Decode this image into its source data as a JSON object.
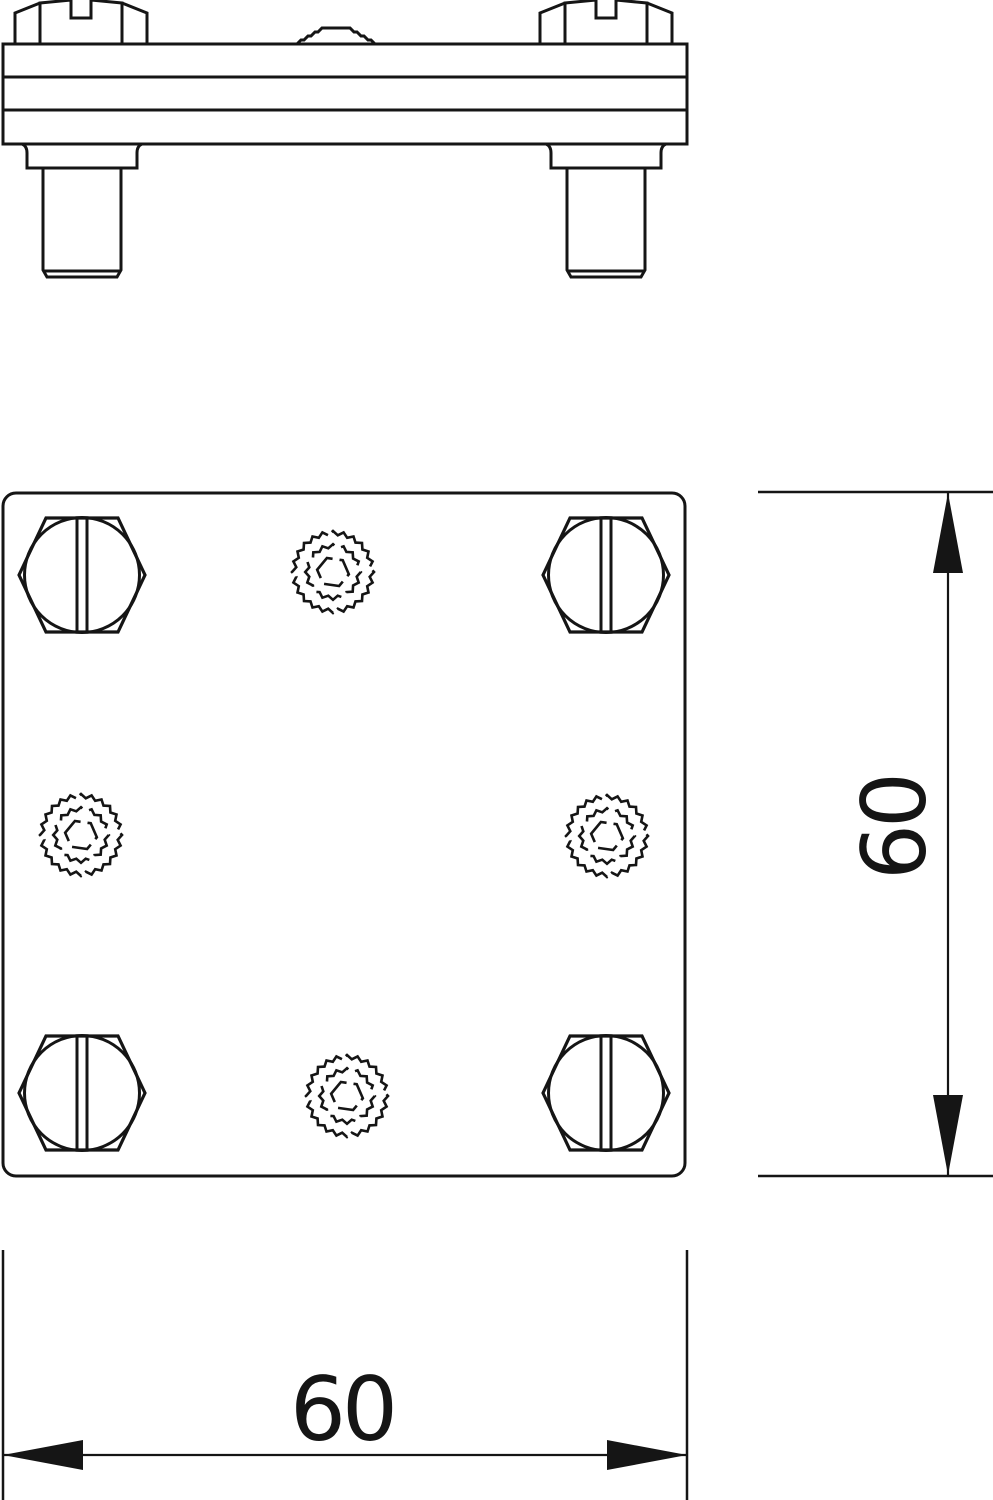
{
  "drawing": {
    "title": "cross-connector-technical-drawing",
    "line_color": "#151515",
    "background": "#ffffff"
  },
  "side_view": {
    "plate": {
      "x1": 3,
      "x2": 687,
      "y_top": 44,
      "y_mid1": 77,
      "y_mid2": 110,
      "y_bottom": 144
    },
    "bolt_heads": [
      {
        "cx": 81
      },
      {
        "cx": 606
      }
    ],
    "studs": [
      {
        "cx": 82
      },
      {
        "cx": 606
      }
    ],
    "dome": {
      "cx": 336,
      "base_y": 44,
      "top_y": 28,
      "base_hw": 39,
      "top_hw": 11
    }
  },
  "plan_view": {
    "plate": {
      "x": 3,
      "y": 493,
      "w": 682,
      "h": 683,
      "rx": 13
    },
    "bolts": [
      {
        "cx": 82,
        "cy": 575
      },
      {
        "cx": 606,
        "cy": 575
      },
      {
        "cx": 82,
        "cy": 1093
      },
      {
        "cx": 606,
        "cy": 1093
      }
    ],
    "knurls": [
      {
        "cx": 333,
        "cy": 572
      },
      {
        "cx": 81,
        "cy": 835
      },
      {
        "cx": 607,
        "cy": 836
      },
      {
        "cx": 347,
        "cy": 1096
      }
    ]
  },
  "dim_vertical": {
    "label": "60",
    "line_x": 948,
    "y1": 492,
    "y2": 1176,
    "ext_x1": 758,
    "ext_x2": 993,
    "text_baseline_x": 925,
    "text_center_y": 828
  },
  "dim_horizontal": {
    "label": "60",
    "line_y": 1455,
    "x1": 3,
    "x2": 687,
    "ext_y1": 1250,
    "ext_y2": 1500,
    "text_center_x": 342,
    "text_baseline_y": 1440
  }
}
